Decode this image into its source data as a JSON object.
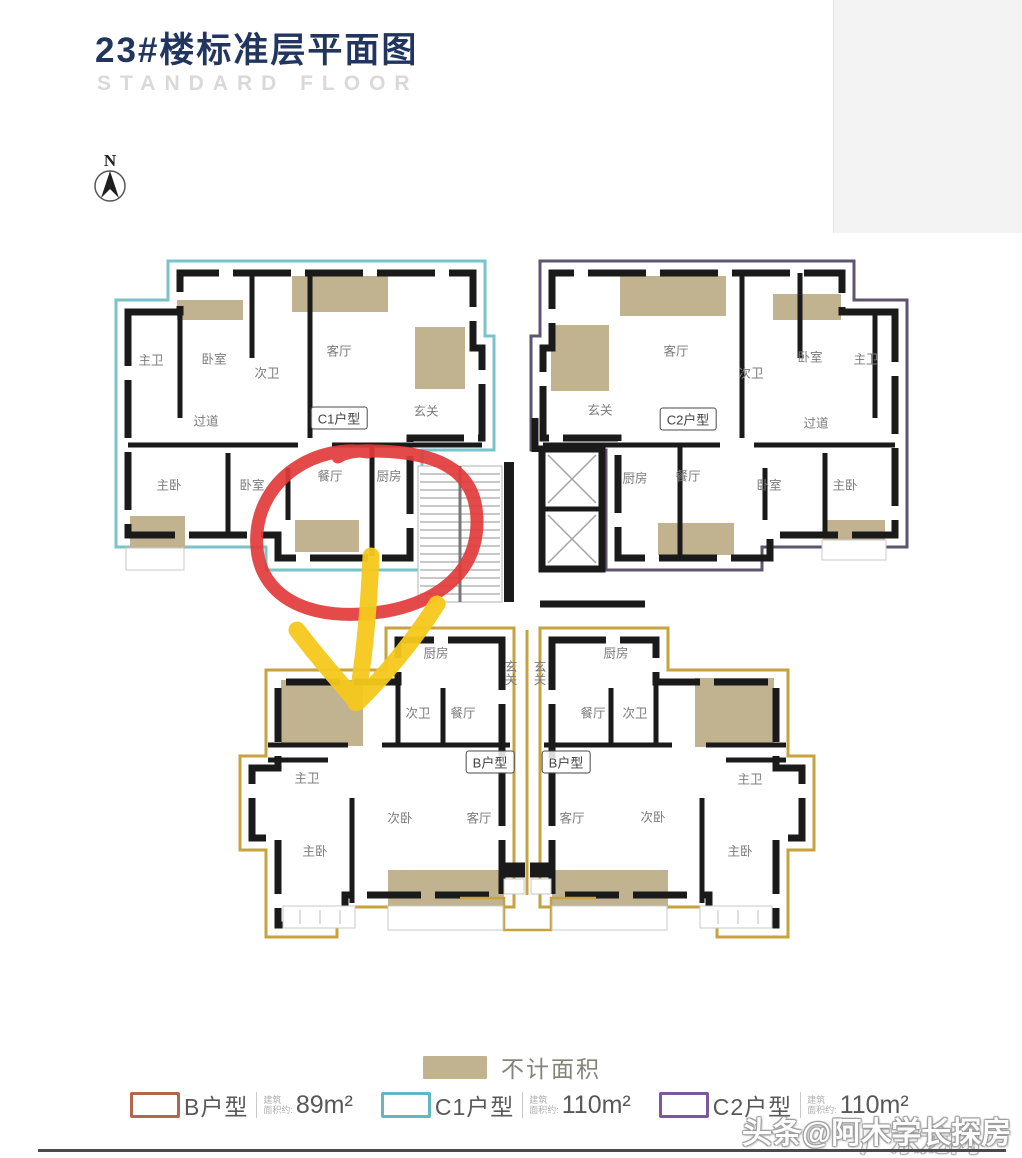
{
  "title": {
    "text": "23#楼标准层平面图",
    "subtitle": "STANDARD FLOOR"
  },
  "compass": {
    "north_label": "N"
  },
  "colors": {
    "title": "#21355f",
    "subtitle": "#d9d9d9",
    "wall": "#1a1a1a",
    "tan": "#c2b390",
    "c1_outline": "#79c3cb",
    "c2_outline": "#5e5470",
    "b_outline": "#c6a33f",
    "red_annotation": "#e23b3b",
    "yellow_annotation": "#f6c91c"
  },
  "unit_tags": [
    {
      "t": "C1户型"
    },
    {
      "t": "C2户型"
    },
    {
      "t": "B户型"
    },
    {
      "t": "B户型"
    }
  ],
  "labels": [
    {
      "t": "主卫"
    },
    {
      "t": "卧室"
    },
    {
      "t": "次卫"
    },
    {
      "t": "客厅"
    },
    {
      "t": "玄关"
    },
    {
      "t": "过道"
    },
    {
      "t": "主卧"
    },
    {
      "t": "卧室"
    },
    {
      "t": "餐厅"
    },
    {
      "t": "厨房"
    },
    {
      "t": "玄关"
    },
    {
      "t": "客厅"
    },
    {
      "t": "次卫"
    },
    {
      "t": "卧室"
    },
    {
      "t": "主卫"
    },
    {
      "t": "过道"
    },
    {
      "t": "厨房"
    },
    {
      "t": "餐厅"
    },
    {
      "t": "卧室"
    },
    {
      "t": "主卧"
    },
    {
      "t": "厨房"
    },
    {
      "t": "玄关"
    },
    {
      "t": "次卫"
    },
    {
      "t": "餐厅"
    },
    {
      "t": "主卫"
    },
    {
      "t": "次卧"
    },
    {
      "t": "客厅"
    },
    {
      "t": "主卧"
    },
    {
      "t": "玄关"
    },
    {
      "t": "厨房"
    },
    {
      "t": "餐厅"
    },
    {
      "t": "次卫"
    },
    {
      "t": "客厅"
    },
    {
      "t": "次卧"
    },
    {
      "t": "主卫"
    },
    {
      "t": "主卧"
    }
  ],
  "legend": {
    "no_area_label": "不计面积",
    "items": [
      {
        "name": "B户型",
        "area_line1": "建筑",
        "area_line2": "面积约:",
        "value": "89m²",
        "swatch_color": "#b4664a"
      },
      {
        "name": "C1户型",
        "area_line1": "建筑",
        "area_line2": "面积约:",
        "value": "110m²",
        "swatch_color": "#62b7c7"
      },
      {
        "name": "C2户型",
        "area_line1": "建筑",
        "area_line2": "面积约:",
        "value": "110m²",
        "swatch_color": "#7b57a0"
      }
    ]
  },
  "watermark": {
    "line1": "头条@阿木学长探房",
    "line2": "广东龙网"
  }
}
